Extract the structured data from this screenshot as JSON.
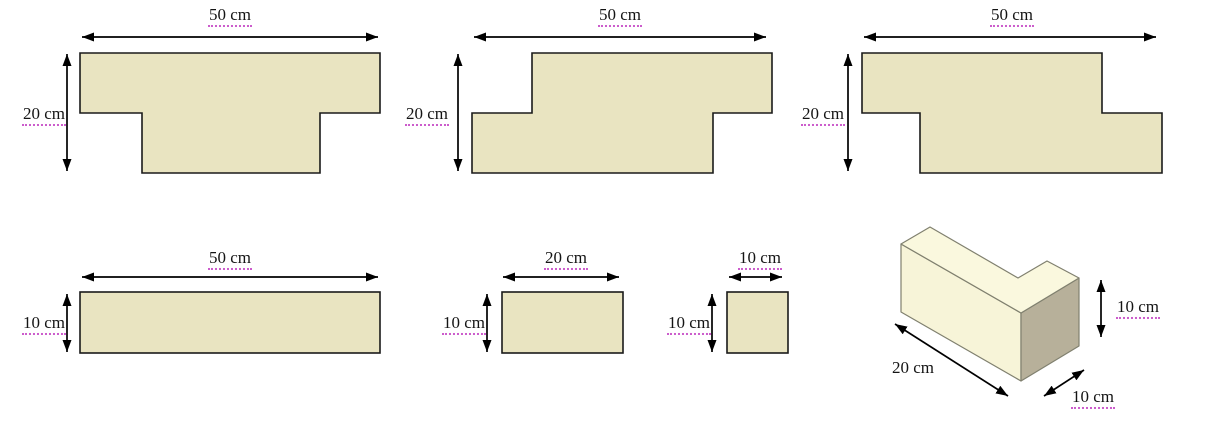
{
  "colors": {
    "page_bg": "#ffffff",
    "shape_fill": "#E9E4C1",
    "shape_stroke": "#1a1a1a",
    "block_top_fill": "#FAF8DE",
    "block_front_fill": "#F7F4D8",
    "block_side_fill": "#B7B09A",
    "block_stroke": "#80806f",
    "dim_color": "#000000",
    "text_color": "#141414",
    "spellcheck_color": "#cc5ccc"
  },
  "figures": [
    {
      "width_label": "50 cm",
      "height_label": "20 cm"
    },
    {
      "width_label": "50 cm",
      "height_label": "20 cm"
    },
    {
      "width_label": "50 cm",
      "height_label": "20 cm"
    },
    {
      "width_label": "50 cm",
      "height_label": "10 cm"
    },
    {
      "width_label": "20 cm",
      "height_label": "10 cm"
    },
    {
      "width_label": "10 cm",
      "height_label": "10 cm"
    },
    {
      "length_label": "20 cm",
      "depth_label": "10 cm",
      "height_label": "10 cm"
    }
  ]
}
